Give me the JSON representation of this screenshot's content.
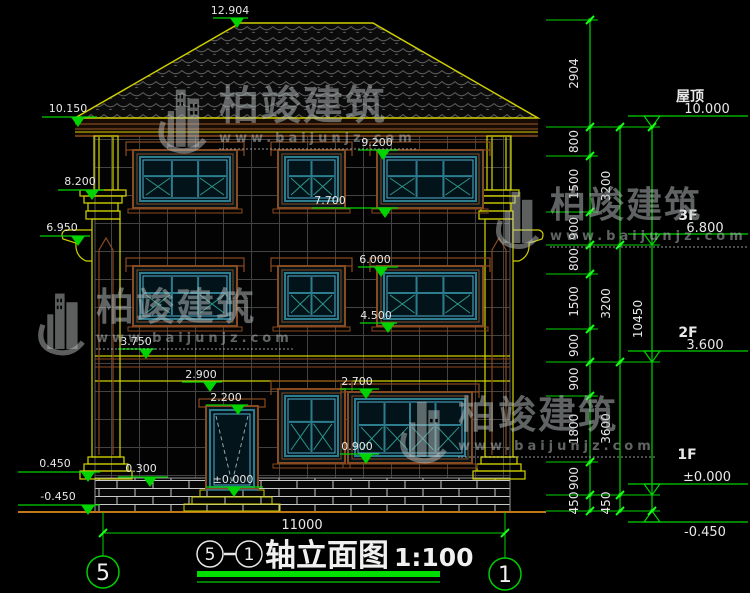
{
  "title": {
    "axis_start": "5",
    "axis_end": "1",
    "main": "轴立面图",
    "scale": "1:100"
  },
  "bottom": {
    "overall_dim": "11000",
    "axis_left": "5",
    "axis_right": "1"
  },
  "watermark": {
    "name": "柏竣建筑",
    "url": "www.baijunjz.com"
  },
  "levels": {
    "center": [
      "12.904",
      "9.200",
      "7.700",
      "6.000",
      "4.500",
      "3.750",
      "2.900",
      "2.700",
      "2.200",
      "0.900",
      "±0.000"
    ],
    "left": [
      "10.150",
      "8.200",
      "6.950",
      "0.450",
      "0.300",
      "-0.450"
    ],
    "right": [
      {
        "name": "屋顶",
        "value": "10.000"
      },
      {
        "name": "3F",
        "value": "6.800"
      },
      {
        "name": "2F",
        "value": "3.600"
      },
      {
        "name": "1F",
        "value": "±0.000"
      },
      {
        "name": "",
        "value": "-0.450"
      }
    ]
  },
  "chains": {
    "inner": [
      "2904",
      "800",
      "1500",
      "900",
      "800",
      "1500",
      "900",
      "900",
      "1800",
      "900",
      "450"
    ],
    "mid": [
      "3200",
      "3200",
      "3600",
      "450"
    ],
    "outer": [
      "10450"
    ]
  },
  "colors": {
    "dim_line": "#00d400",
    "bright_tick": "#18ff18",
    "text": "#e8e8e8",
    "roof_outline": "#cfcf00",
    "trim": "#8a4a1f",
    "frame": "#2d7d8f",
    "frame_light": "#52aed0",
    "ground": "#c07818",
    "grid": "#434343",
    "watermark": "#b4b8b8"
  }
}
